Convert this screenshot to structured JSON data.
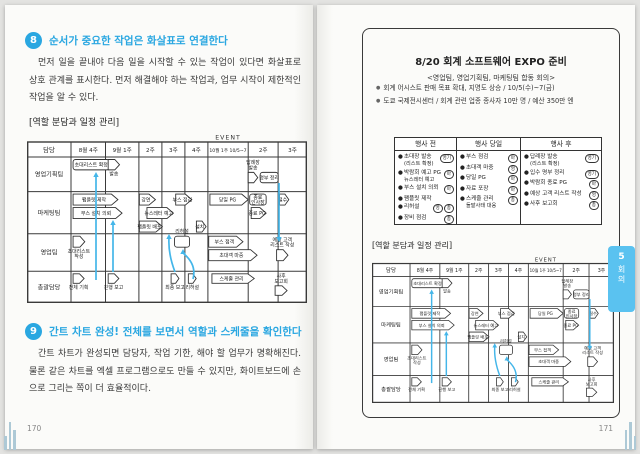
{
  "colors": {
    "accent_blue": "#2aa7e1",
    "arrow_blue": "#44b6e9",
    "tab_blue": "#5ac2f0"
  },
  "bullet_glyph": "●",
  "left_page": {
    "section8": {
      "number": "8",
      "title": "순서가 중요한 작업은 화살표로 연결한다",
      "body": "먼저 일을 끝내야 다음 일을 시작할 수 있는 작업이 있다면 화살표로 상호 관계를 표시한다. 먼저 해결해야 하는 작업과, 업무 시작이 제한적인 작업을 알 수 있다."
    },
    "section9": {
      "number": "9",
      "title": "간트 차트 완성! 전체를 보면서 역할과 스케줄을 확인한다",
      "body": "간트 차트가 완성되면 담당자, 작업 기한, 해야 할 업무가 명확해진다. 물론 같은 차트를 엑셀 프로그램으로도 만들 수 있지만, 화이트보드에 손으로 그리는 쪽이 더 효율적이다."
    },
    "page_number": "170"
  },
  "right_page": {
    "board": {
      "title": "8/20 회계 소프트웨어 EXPO 준비",
      "subtitle": "<영업팀, 영업기획팀, 마케팅팀 합동 회의>",
      "bullets": [
        "회계 어시스트 판매 목표 확대, 지명도 상승 / 10/5(수)~7(금)",
        "도쿄 국제전시센터 / 회계 관련 업종 종사자 10만 명 / 예산 350만 엔"
      ],
      "task_table": {
        "headers": [
          "행사 전",
          "행사 당일",
          "행사 후"
        ],
        "columns": [
          [
            {
              "text": "초대장 발송",
              "sub": "(리스트 확정)",
              "owners": [
                "영기"
              ]
            },
            {
              "text": "박람회 예고 PG",
              "sub": "뉴스레터 예고",
              "owners": [
                "마"
              ]
            },
            {
              "text": "부스 설치 의뢰",
              "owners": [
                "마"
              ]
            },
            {
              "text": "팸플릿 제작",
              "owners": []
            },
            {
              "text": "리허설",
              "owners": [
                "영",
                "총"
              ]
            },
            {
              "text": "장비 점검",
              "owners": [
                "총"
              ]
            }
          ],
          [
            {
              "text": "부스 점검",
              "owners": [
                "마"
              ]
            },
            {
              "text": "초대객 마중",
              "owners": [
                "영"
              ]
            },
            {
              "text": "당일 PG",
              "owners": [
                "마"
              ]
            },
            {
              "text": "자료 포장",
              "owners": [
                "마"
              ]
            },
            {
              "text": "스케줄 관리",
              "sub": "돌발사태 대응",
              "owners": [
                "총"
              ]
            }
          ],
          [
            {
              "text": "답례장 발송",
              "sub": "(리스트 확정)",
              "owners": [
                "영기"
              ]
            },
            {
              "text": "입수 명부 정리",
              "owners": [
                "영기"
              ]
            },
            {
              "text": "박람회 종료 PG",
              "owners": [
                "마"
              ]
            },
            {
              "text": "예상 고객 리스트 작성",
              "owners": [
                "영"
              ]
            },
            {
              "text": "사후 보고회",
              "owners": [
                "총"
              ]
            }
          ]
        ]
      }
    },
    "chapter_tab": {
      "number": "5",
      "label": "회의"
    },
    "page_number": "171"
  },
  "gantt": {
    "caption": "[역할 분담과 일정 관리]",
    "event_label": "EVENT",
    "columns": [
      "담당",
      "8월 4주",
      "9월 1주",
      "2주",
      "3주",
      "4주",
      "10월 1주 10/5~7",
      "2주",
      "3주"
    ],
    "rows": [
      "영업기획팀",
      "마케팅팀",
      "영업팀",
      "총괄담당"
    ],
    "bars": [
      {
        "r": 0,
        "c": 1.06,
        "span": 1.05,
        "lane": 0,
        "shape": "box",
        "label": "초대리스트 확정",
        "pos": "in"
      },
      {
        "r": 0,
        "c": 2.08,
        "span": 0.34,
        "lane": 0,
        "shape": "pent",
        "label": "발송",
        "pos": "below"
      },
      {
        "r": 0,
        "c": 7.0,
        "span": 0.32,
        "lane": 1,
        "shape": "pent",
        "label": "답례장\n발송",
        "pos": "above"
      },
      {
        "r": 0,
        "c": 7.4,
        "span": 0.6,
        "lane": 1,
        "shape": "box",
        "label": "명부 정리",
        "pos": "in"
      },
      {
        "r": 1,
        "c": 1.06,
        "span": 1.3,
        "lane": 0,
        "shape": "pent",
        "label": "팸플릿 제작",
        "pos": "in"
      },
      {
        "r": 1,
        "c": 1.06,
        "span": 1.42,
        "lane": 1,
        "shape": "pent",
        "label": "부스 설치 의뢰",
        "pos": "in"
      },
      {
        "r": 1,
        "c": 3.02,
        "span": 0.7,
        "lane": 0,
        "shape": "pent",
        "label": "강연",
        "pos": "in"
      },
      {
        "r": 1,
        "c": 3.35,
        "span": 1.15,
        "lane": 1,
        "shape": "pent",
        "label": "뉴스레터 예고",
        "pos": "in"
      },
      {
        "r": 1,
        "c": 3.02,
        "span": 1.0,
        "lane": 2,
        "shape": "pent",
        "label": "팸플릿 배포",
        "pos": "in"
      },
      {
        "r": 1,
        "c": 4.6,
        "span": 0.7,
        "lane": 0,
        "shape": "pent",
        "label": "부스 점검",
        "pos": "in"
      },
      {
        "r": 1,
        "c": 5.5,
        "span": 0.42,
        "lane": 2,
        "shape": "pent",
        "label": "설치",
        "pos": "in"
      },
      {
        "r": 1,
        "c": 6.05,
        "span": 0.95,
        "lane": 0,
        "shape": "pent",
        "label": "당일 PG",
        "pos": "in"
      },
      {
        "r": 1,
        "c": 7.05,
        "span": 0.55,
        "lane": 0,
        "shape": "box",
        "label": "종료\n인사장",
        "pos": "in"
      },
      {
        "r": 1,
        "c": 7.1,
        "span": 0.5,
        "lane": 1,
        "shape": "pent",
        "label": "종료 PG",
        "pos": "in"
      },
      {
        "r": 1,
        "c": 8.05,
        "span": 0.32,
        "lane": 0,
        "shape": "pent",
        "label": "철수",
        "pos": "in"
      },
      {
        "r": 2,
        "c": 1.06,
        "span": 0.34,
        "lane": 0,
        "shape": "pent",
        "label": "초대리스트\n작성",
        "pos": "below"
      },
      {
        "r": 2,
        "c": 4.55,
        "span": 0.65,
        "lane": 0,
        "shape": "box",
        "label": "리허설",
        "pos": "above"
      },
      {
        "r": 2,
        "c": 6.02,
        "span": 0.85,
        "lane": 0,
        "shape": "pent",
        "label": "부스 접객",
        "pos": "in"
      },
      {
        "r": 2,
        "c": 6.02,
        "span": 1.2,
        "lane": 1,
        "shape": "pent",
        "label": "초대객 마중",
        "pos": "in"
      },
      {
        "r": 2,
        "c": 7.95,
        "span": 0.38,
        "lane": 1,
        "shape": "pent",
        "label": "예상 고객\n리스트 작성",
        "pos": "above"
      },
      {
        "r": 3,
        "c": 1.06,
        "span": 0.32,
        "lane": 0,
        "shape": "pent",
        "label": "전체 기획",
        "pos": "below"
      },
      {
        "r": 3,
        "c": 2.08,
        "span": 0.32,
        "lane": 0,
        "shape": "pent",
        "label": "진행 보고",
        "pos": "below"
      },
      {
        "r": 3,
        "c": 4.4,
        "span": 0.34,
        "lane": 0,
        "shape": "pent",
        "label": "최종 보고",
        "pos": "below"
      },
      {
        "r": 3,
        "c": 5.15,
        "span": 0.34,
        "lane": 0,
        "shape": "pent",
        "label": "리허설",
        "pos": "below"
      },
      {
        "r": 3,
        "c": 6.1,
        "span": 1.05,
        "lane": 0,
        "shape": "pent",
        "label": "스케줄 관리",
        "pos": "in"
      },
      {
        "r": 3,
        "c": 7.9,
        "span": 0.4,
        "lane": 1,
        "shape": "pent",
        "label": "사후\n보고회",
        "pos": "above"
      }
    ],
    "arrows": [
      {
        "x1": 69,
        "y1": 149,
        "x2": 69,
        "y2": 42
      },
      {
        "x1": 86,
        "y1": 141,
        "x2": 86,
        "y2": 90
      },
      {
        "x1": 148,
        "y1": 141,
        "x2": 142,
        "y2": 104,
        "curve": -4
      },
      {
        "x1": 166,
        "y1": 148,
        "x2": 156,
        "y2": 119,
        "curve": 9
      },
      {
        "x1": 252,
        "y1": 52,
        "x2": 252,
        "y2": 110
      }
    ]
  }
}
